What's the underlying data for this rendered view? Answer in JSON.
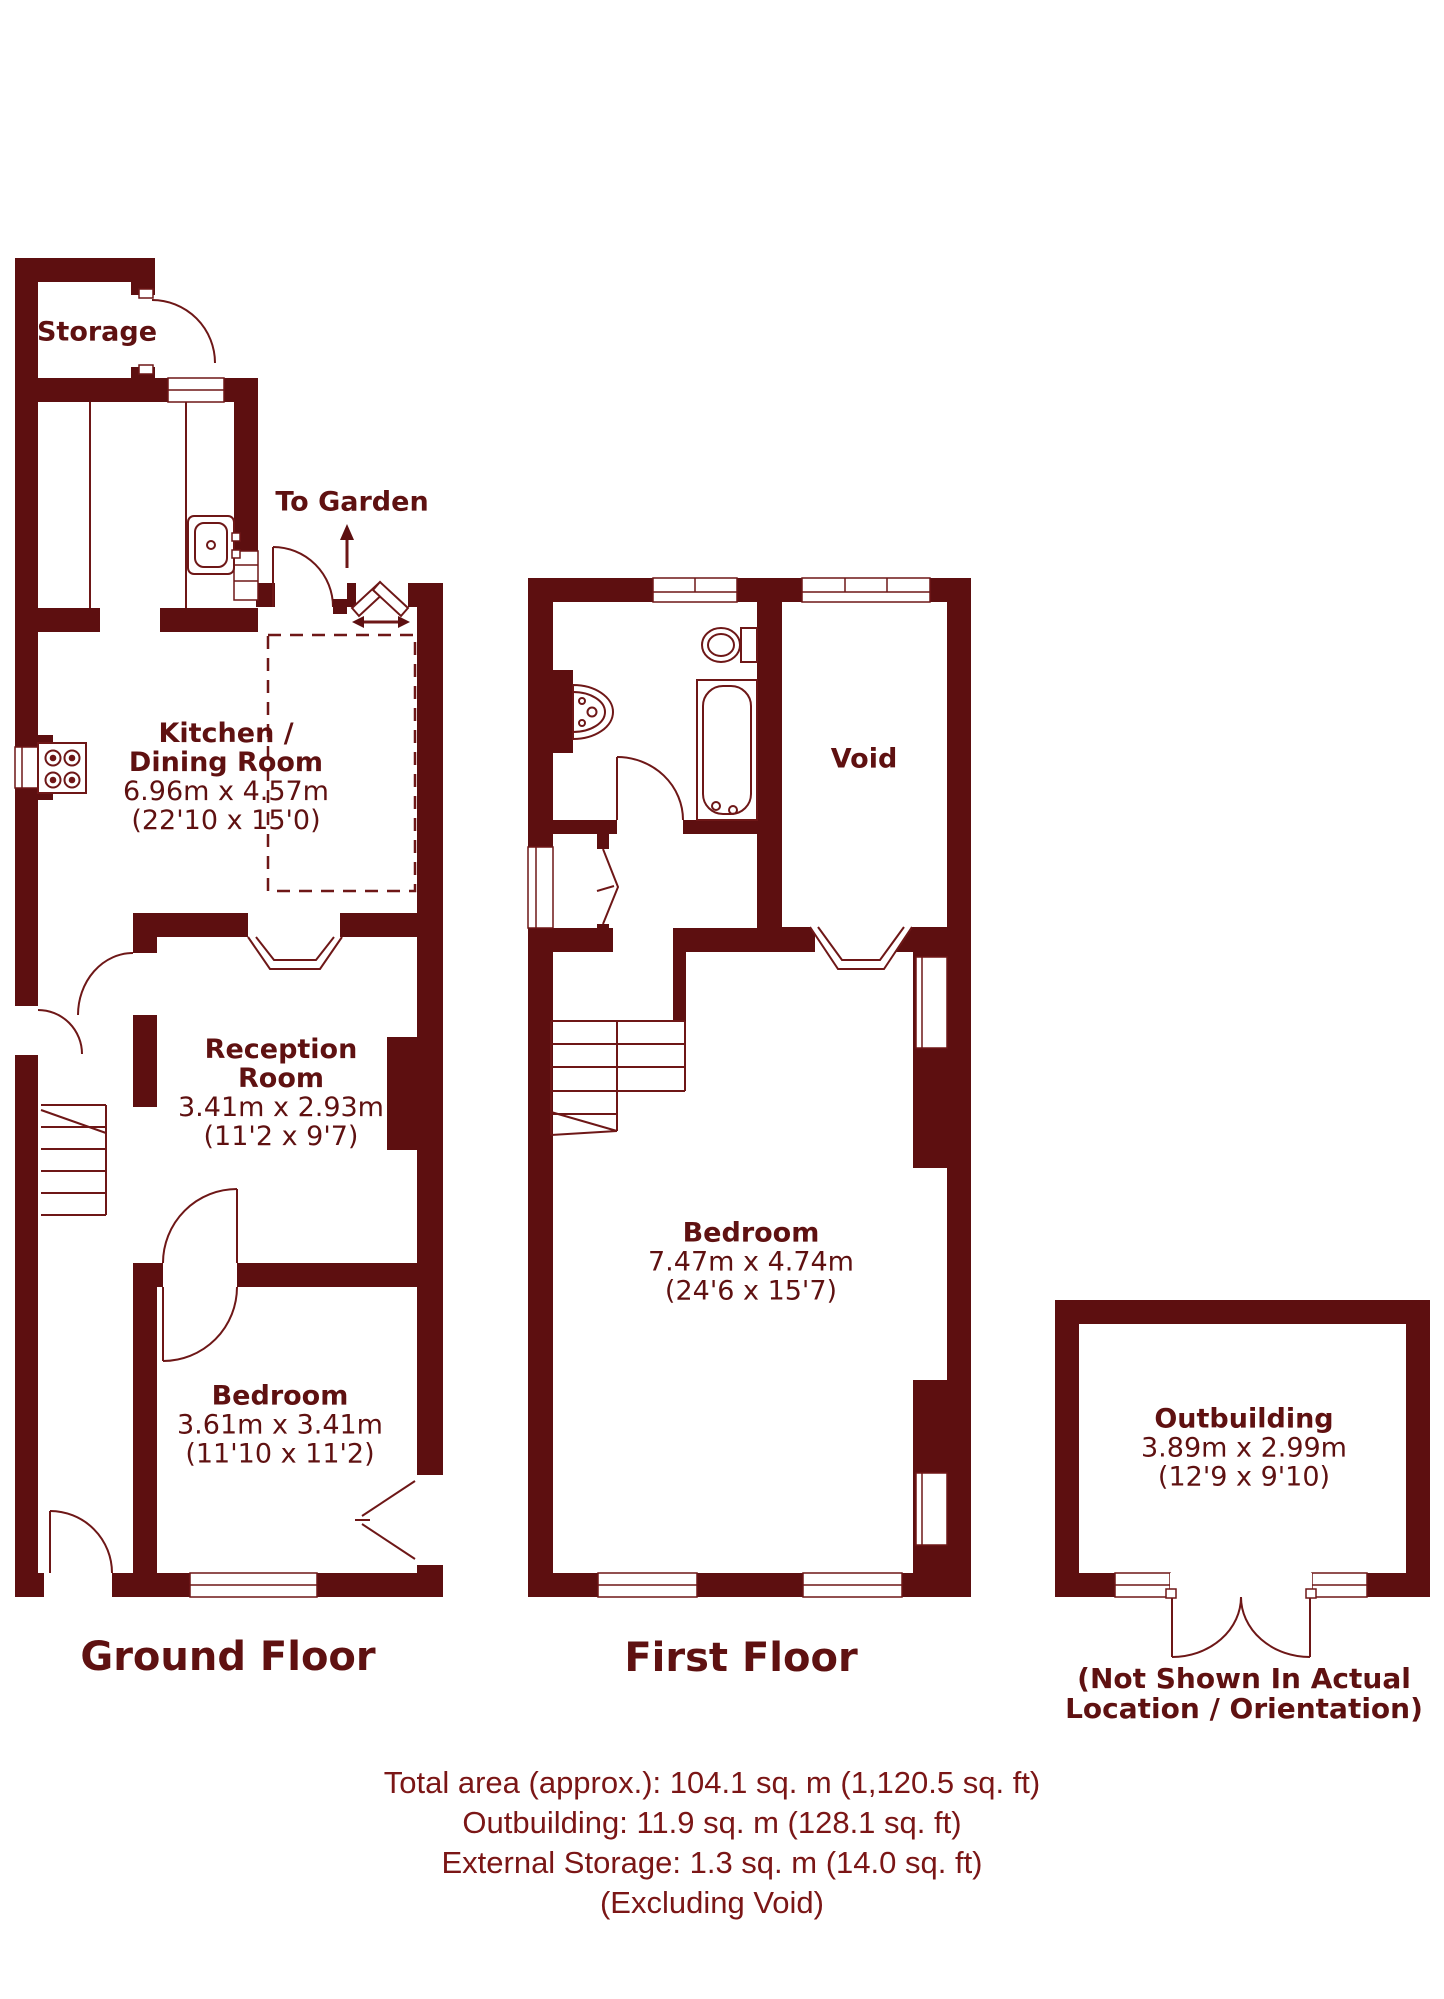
{
  "colors": {
    "wall": "#5d0f10",
    "line": "#6e1717",
    "label_text": "#5f1111",
    "summary_text": "#7b1616"
  },
  "ground_floor": {
    "label": "Ground Floor",
    "storage": {
      "name": "Storage"
    },
    "to_garden": {
      "label": "To Garden"
    },
    "kitchen": {
      "name_line1": "Kitchen /",
      "name_line2": "Dining Room",
      "dims_metric": "6.96m x 4.57m",
      "dims_imperial": "(22'10 x 15'0)"
    },
    "reception": {
      "name_line1": "Reception",
      "name_line2": "Room",
      "dims_metric": "3.41m x 2.93m",
      "dims_imperial": "(11'2 x 9'7)"
    },
    "bedroom": {
      "name": "Bedroom",
      "dims_metric": "3.61m x 3.41m",
      "dims_imperial": "(11'10 x 11'2)"
    }
  },
  "first_floor": {
    "label": "First Floor",
    "void_room": {
      "name": "Void"
    },
    "bedroom": {
      "name": "Bedroom",
      "dims_metric": "7.47m x 4.74m",
      "dims_imperial": "(24'6 x 15'7)"
    }
  },
  "outbuilding": {
    "name": "Outbuilding",
    "dims_metric": "3.89m x 2.99m",
    "dims_imperial": "(12'9 x 9'10)",
    "note_line1": "(Not Shown In Actual",
    "note_line2": "Location / Orientation)"
  },
  "summary": {
    "total_area": "Total area (approx.): 104.1 sq. m (1,120.5 sq. ft)",
    "outbuilding_area": "Outbuilding: 11.9 sq. m (128.1 sq. ft)",
    "external_storage": "External Storage: 1.3 sq. m (14.0 sq. ft)",
    "excluding": "(Excluding Void)"
  }
}
